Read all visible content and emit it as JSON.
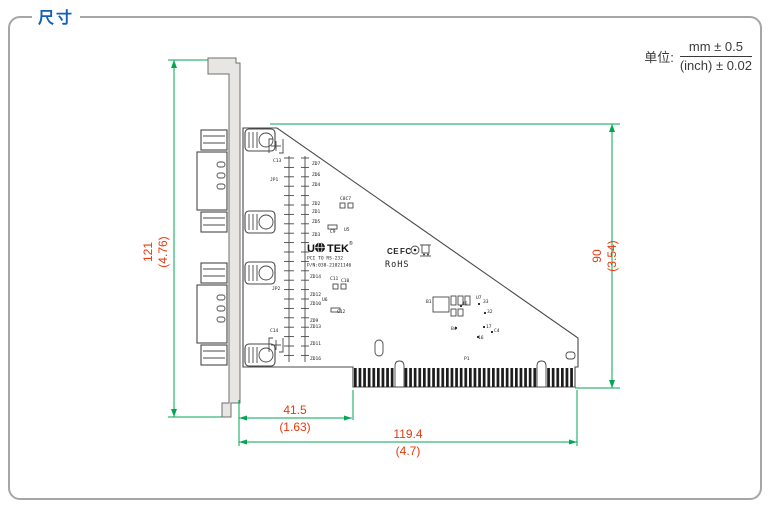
{
  "page": {
    "title": "尺寸"
  },
  "unit": {
    "label": "单位:",
    "numerator": "mm ± 0.5",
    "denominator": "(inch) ± 0.02"
  },
  "colors": {
    "accent_blue": "#1060b8",
    "dim_line_green": "#00a651",
    "dim_text_red": "#e8380d"
  },
  "dimensions": {
    "bracket_height": {
      "mm": "121",
      "inch": "(4.76)"
    },
    "board_height": {
      "mm": "90",
      "inch": "(3.54)"
    },
    "edge_offset": {
      "mm": "41.5",
      "inch": "(1.63)"
    },
    "board_length": {
      "mm": "119.4",
      "inch": "(4.7)"
    }
  },
  "board": {
    "silk": {
      "brand_u": "U",
      "brand_tek": "TEK",
      "reg": "®",
      "model": "PCI TO RS-232",
      "part_number": "P/N:038-21021146",
      "rohs": "RoHS",
      "ce": "CE",
      "fcc": "FC",
      "p1": "P1"
    },
    "component_labels": [
      {
        "text": "C13",
        "x": 273,
        "y": 162
      },
      {
        "text": "JP1",
        "x": 270,
        "y": 181
      },
      {
        "text": "JP2",
        "x": 272,
        "y": 290
      },
      {
        "text": "C14",
        "x": 270,
        "y": 332
      },
      {
        "text": "ZD7",
        "x": 312,
        "y": 165
      },
      {
        "text": "ZD6",
        "x": 312,
        "y": 176
      },
      {
        "text": "ZD4",
        "x": 312,
        "y": 186
      },
      {
        "text": "ZD2",
        "x": 312,
        "y": 205
      },
      {
        "text": "ZD1",
        "x": 312,
        "y": 213
      },
      {
        "text": "ZD5",
        "x": 312,
        "y": 223
      },
      {
        "text": "ZD3",
        "x": 312,
        "y": 236
      },
      {
        "text": "ZD14",
        "x": 310,
        "y": 278
      },
      {
        "text": "ZD12",
        "x": 310,
        "y": 296
      },
      {
        "text": "ZD10",
        "x": 310,
        "y": 305
      },
      {
        "text": "ZD9",
        "x": 310,
        "y": 322
      },
      {
        "text": "ZD13",
        "x": 310,
        "y": 328
      },
      {
        "text": "ZD11",
        "x": 310,
        "y": 345
      },
      {
        "text": "ZD16",
        "x": 310,
        "y": 360
      },
      {
        "text": "C8C7",
        "x": 340,
        "y": 200
      },
      {
        "text": "C9",
        "x": 330,
        "y": 233
      },
      {
        "text": "U5",
        "x": 344,
        "y": 231
      },
      {
        "text": "C11",
        "x": 330,
        "y": 280
      },
      {
        "text": "C10",
        "x": 341,
        "y": 282
      },
      {
        "text": "U6",
        "x": 322,
        "y": 301
      },
      {
        "text": "C12",
        "x": 337,
        "y": 313
      },
      {
        "text": "B1",
        "x": 426,
        "y": 303
      },
      {
        "text": "46",
        "x": 462,
        "y": 305
      },
      {
        "text": "U7",
        "x": 476,
        "y": 299
      },
      {
        "text": "33",
        "x": 483,
        "y": 303
      },
      {
        "text": "32",
        "x": 487,
        "y": 313
      },
      {
        "text": "B4",
        "x": 451,
        "y": 330
      },
      {
        "text": "17",
        "x": 486,
        "y": 328
      },
      {
        "text": "C4",
        "x": 494,
        "y": 332
      },
      {
        "text": "16",
        "x": 478,
        "y": 339
      }
    ]
  }
}
